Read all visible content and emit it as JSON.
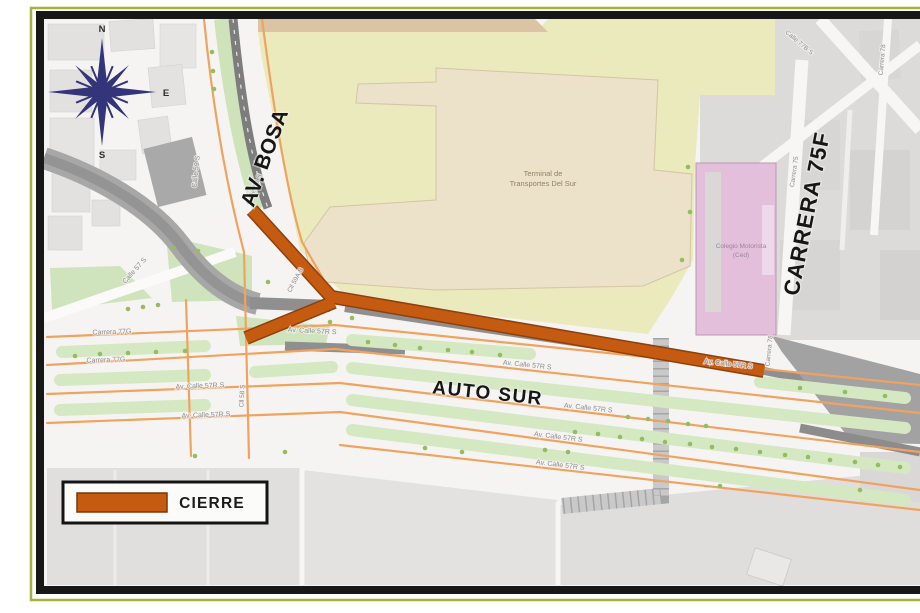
{
  "page": {
    "compass": {
      "n": "N",
      "e": "E",
      "s": "S",
      "w": "W"
    },
    "roads_major": {
      "av_bosa": "AV. BOSA",
      "auto_sur": "AUTO SUR",
      "carrera_75f": "CARRERA 75F"
    },
    "streets": {
      "calle_59_s": "Calle 59 S",
      "calle_57_s": "Calle 57 S",
      "cll_59a_s": "Cll 59A S",
      "cll_58_s": "Cll 58 S",
      "carrera_77g": "Carrera 77G",
      "av_calle_57r_s": "Av. Calle 57R S",
      "carrera_78": "Carrera 78",
      "carrera_75": "Carrera 75",
      "calle_77b_s": "Calle 77B S"
    },
    "places": {
      "terminal_l1": "Terminal de",
      "terminal_l2": "Transportes Del Sur",
      "colegio_l1": "Colegio Motorista",
      "colegio_l2": "(Ced)"
    },
    "legend": {
      "closure_label": "CIERRE"
    },
    "colors": {
      "closure": "#C55A11",
      "closure_edge": "#8E410C",
      "road_orange": "#F0A35E",
      "frame_olive": "#A6B23C"
    }
  }
}
